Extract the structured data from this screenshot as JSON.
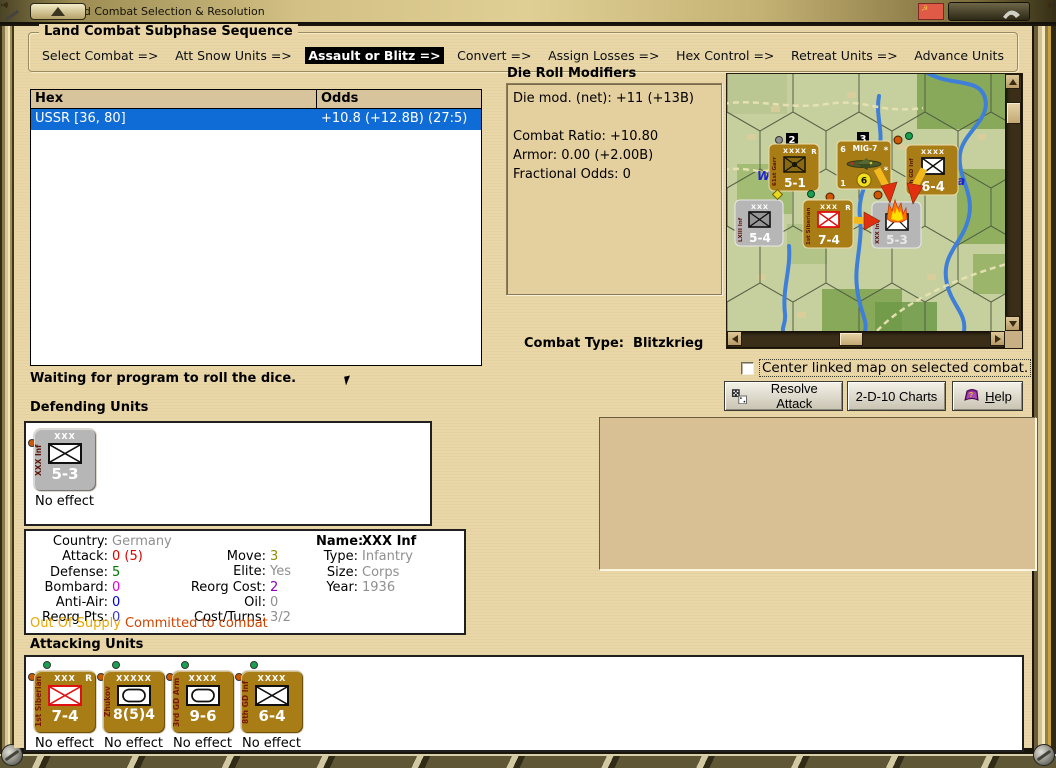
{
  "window": {
    "title": "Land Combat Selection & Resolution"
  },
  "subphase": {
    "title": "Land Combat Subphase Sequence",
    "steps": [
      {
        "label": "Select Combat =>",
        "active": false
      },
      {
        "label": "Att Snow Units =>",
        "active": false
      },
      {
        "label": "Assault or Blitz =>",
        "active": true
      },
      {
        "label": "Convert =>",
        "active": false
      },
      {
        "label": "Assign Losses =>",
        "active": false
      },
      {
        "label": "Hex Control =>",
        "active": false
      },
      {
        "label": "Retreat Units =>",
        "active": false
      },
      {
        "label": "Advance Units",
        "active": false
      }
    ]
  },
  "combat_table": {
    "columns": [
      "Hex",
      "Odds"
    ],
    "rows": [
      {
        "hex": "USSR [36, 80]",
        "odds": "+10.8 (+12.8B) (27:5)",
        "selected": true
      }
    ]
  },
  "die_modifiers": {
    "title": "Die Roll Modifiers",
    "lines": [
      "Die mod. (net): +11 (+13B)",
      "",
      "Combat Ratio: +10.80",
      "Armor: 0.00 (+2.00B)",
      "Fractional Odds: 0"
    ]
  },
  "combat_type": {
    "label": "Combat Type:",
    "value": "Blitzkrieg"
  },
  "status_text": "Waiting for program to roll the dice.",
  "checkbox": {
    "label": "Center linked map on selected combat.",
    "checked": false
  },
  "buttons": {
    "resolve": "Resolve Attack",
    "charts": "2-D-10 Charts",
    "help_first": "H",
    "help_rest": "elp"
  },
  "defending": {
    "heading": "Defending Units",
    "units": [
      {
        "size": "XXX",
        "name": "XXX Inf",
        "strength": "5-3",
        "result": "No effect",
        "symbol": "infantry"
      }
    ]
  },
  "attacking": {
    "heading": "Attacking Units",
    "units": [
      {
        "size": "XXX",
        "flag": "R",
        "name": "1st Siberian",
        "strength": "7-4",
        "result": "No effect",
        "symbol": "infantry-red"
      },
      {
        "size": "XXXXX",
        "flag": "",
        "name": "Zhukov",
        "strength": "8(5)4",
        "result": "No effect",
        "symbol": "armor"
      },
      {
        "size": "XXXX",
        "flag": "",
        "name": "3rd GD Arm",
        "strength": "9-6",
        "result": "No effect",
        "symbol": "armor"
      },
      {
        "size": "XXXX",
        "flag": "",
        "name": "8th GD Inf",
        "strength": "6-4",
        "result": "No effect",
        "symbol": "infantry"
      }
    ]
  },
  "details": {
    "col1": [
      {
        "label": "Country:",
        "value": "Germany",
        "color": "#8f8f8f"
      },
      {
        "label": "Attack:",
        "value": "0 (5)",
        "color": "#e00000"
      },
      {
        "label": "Defense:",
        "value": "5",
        "color": "#007800"
      },
      {
        "label": "Bombard:",
        "value": "0",
        "color": "#e000d8"
      },
      {
        "label": "Anti-Air:",
        "value": "0",
        "color": "#0000d8"
      },
      {
        "label": "Reorg Pts:",
        "value": "0",
        "color": "#3838c8"
      }
    ],
    "col2": [
      {
        "label": "Move:",
        "value": "3",
        "color": "#909000"
      },
      {
        "label": "Elite:",
        "value": "Yes",
        "color": "#8f8f8f"
      },
      {
        "label": "Reorg Cost:",
        "value": "2",
        "color": "#8800b8"
      },
      {
        "label": "Oil:",
        "value": "0",
        "color": "#8f8f8f"
      },
      {
        "label": "Cost/Turns:",
        "value": "3/2",
        "color": "#8f8f8f"
      }
    ],
    "col3": [
      {
        "label": "Name:",
        "value": "XXX Inf",
        "color": "#000000"
      },
      {
        "label": "Type:",
        "value": "Infantry",
        "color": "#8f8f8f"
      },
      {
        "label": "Size:",
        "value": "Corps",
        "color": "#8f8f8f"
      },
      {
        "label": "Year:",
        "value": "1936",
        "color": "#8f8f8f"
      }
    ],
    "footer": [
      {
        "text": "Out Of Supply",
        "color": "#e8a800"
      },
      {
        "text": "Committed to combat",
        "color": "#cc4400"
      }
    ]
  },
  "map": {
    "stack_badges": [
      {
        "value": "2"
      },
      {
        "value": "3"
      }
    ],
    "place_labels": [
      {
        "text": "W"
      },
      {
        "text": "otsa"
      }
    ],
    "counters": {
      "c51": {
        "size": "XXXX",
        "flag": "R",
        "name": "61st Garr",
        "strength": "5-1"
      },
      "mig": {
        "top_left": "6",
        "title": "MIG-7",
        "star": "*",
        "bottom_left": "1",
        "range": "6",
        "star2": "*"
      },
      "c64": {
        "size": "XXXX",
        "name": "8th GD Inf",
        "strength": "6-4"
      },
      "c54": {
        "size": "XXX",
        "name": "LXIII Inf",
        "strength": "5-4"
      },
      "c74": {
        "size": "XXX",
        "flag": "R",
        "name": "1st Siberian",
        "strength": "7-4"
      },
      "c53": {
        "name": "XXX Inf",
        "strength": "5-3"
      }
    }
  },
  "colors": {
    "selection_blue": "#0f6bd6",
    "counter_brown": "#a87d15",
    "counter_gray": "#b6b6b6",
    "land_green": "#c6d09e",
    "forest_green": "#7da24e",
    "river_blue": "#3f7fd8",
    "road_tan": "#e8e2b4",
    "background_tan": "#e9d5a5"
  },
  "icons": {
    "resolve_button": "dice-icon",
    "help_button": "book-icon",
    "titlebar_flag": "soviet-flag-icon"
  }
}
